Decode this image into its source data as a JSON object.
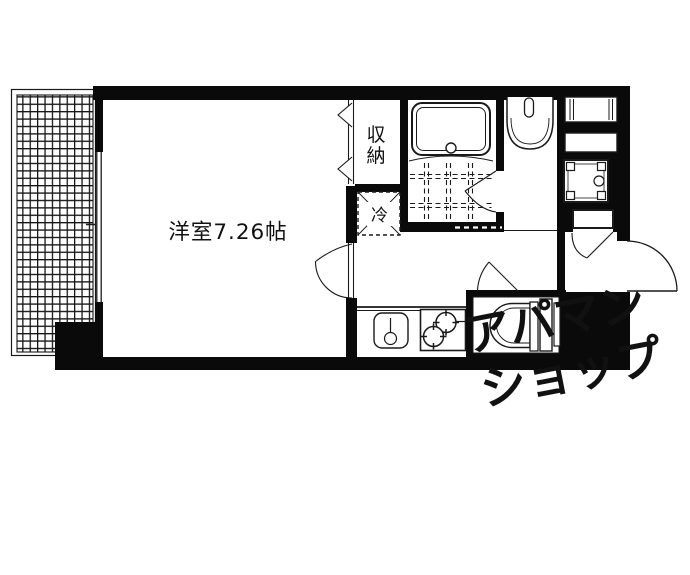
{
  "floorplan": {
    "room": {
      "label": "洋室7.26帖"
    },
    "closet": {
      "label": "収納",
      "chars": [
        "収",
        "納"
      ]
    },
    "refrigerator": {
      "label": "冷"
    },
    "watermark": {
      "line1": "アパマン",
      "line2": "ショップ"
    },
    "colors": {
      "ink": "#1a1a1a",
      "wall": "#0a0a0a",
      "background": "#ffffff",
      "watermark": "rgba(200,130,60,0.30)"
    }
  }
}
